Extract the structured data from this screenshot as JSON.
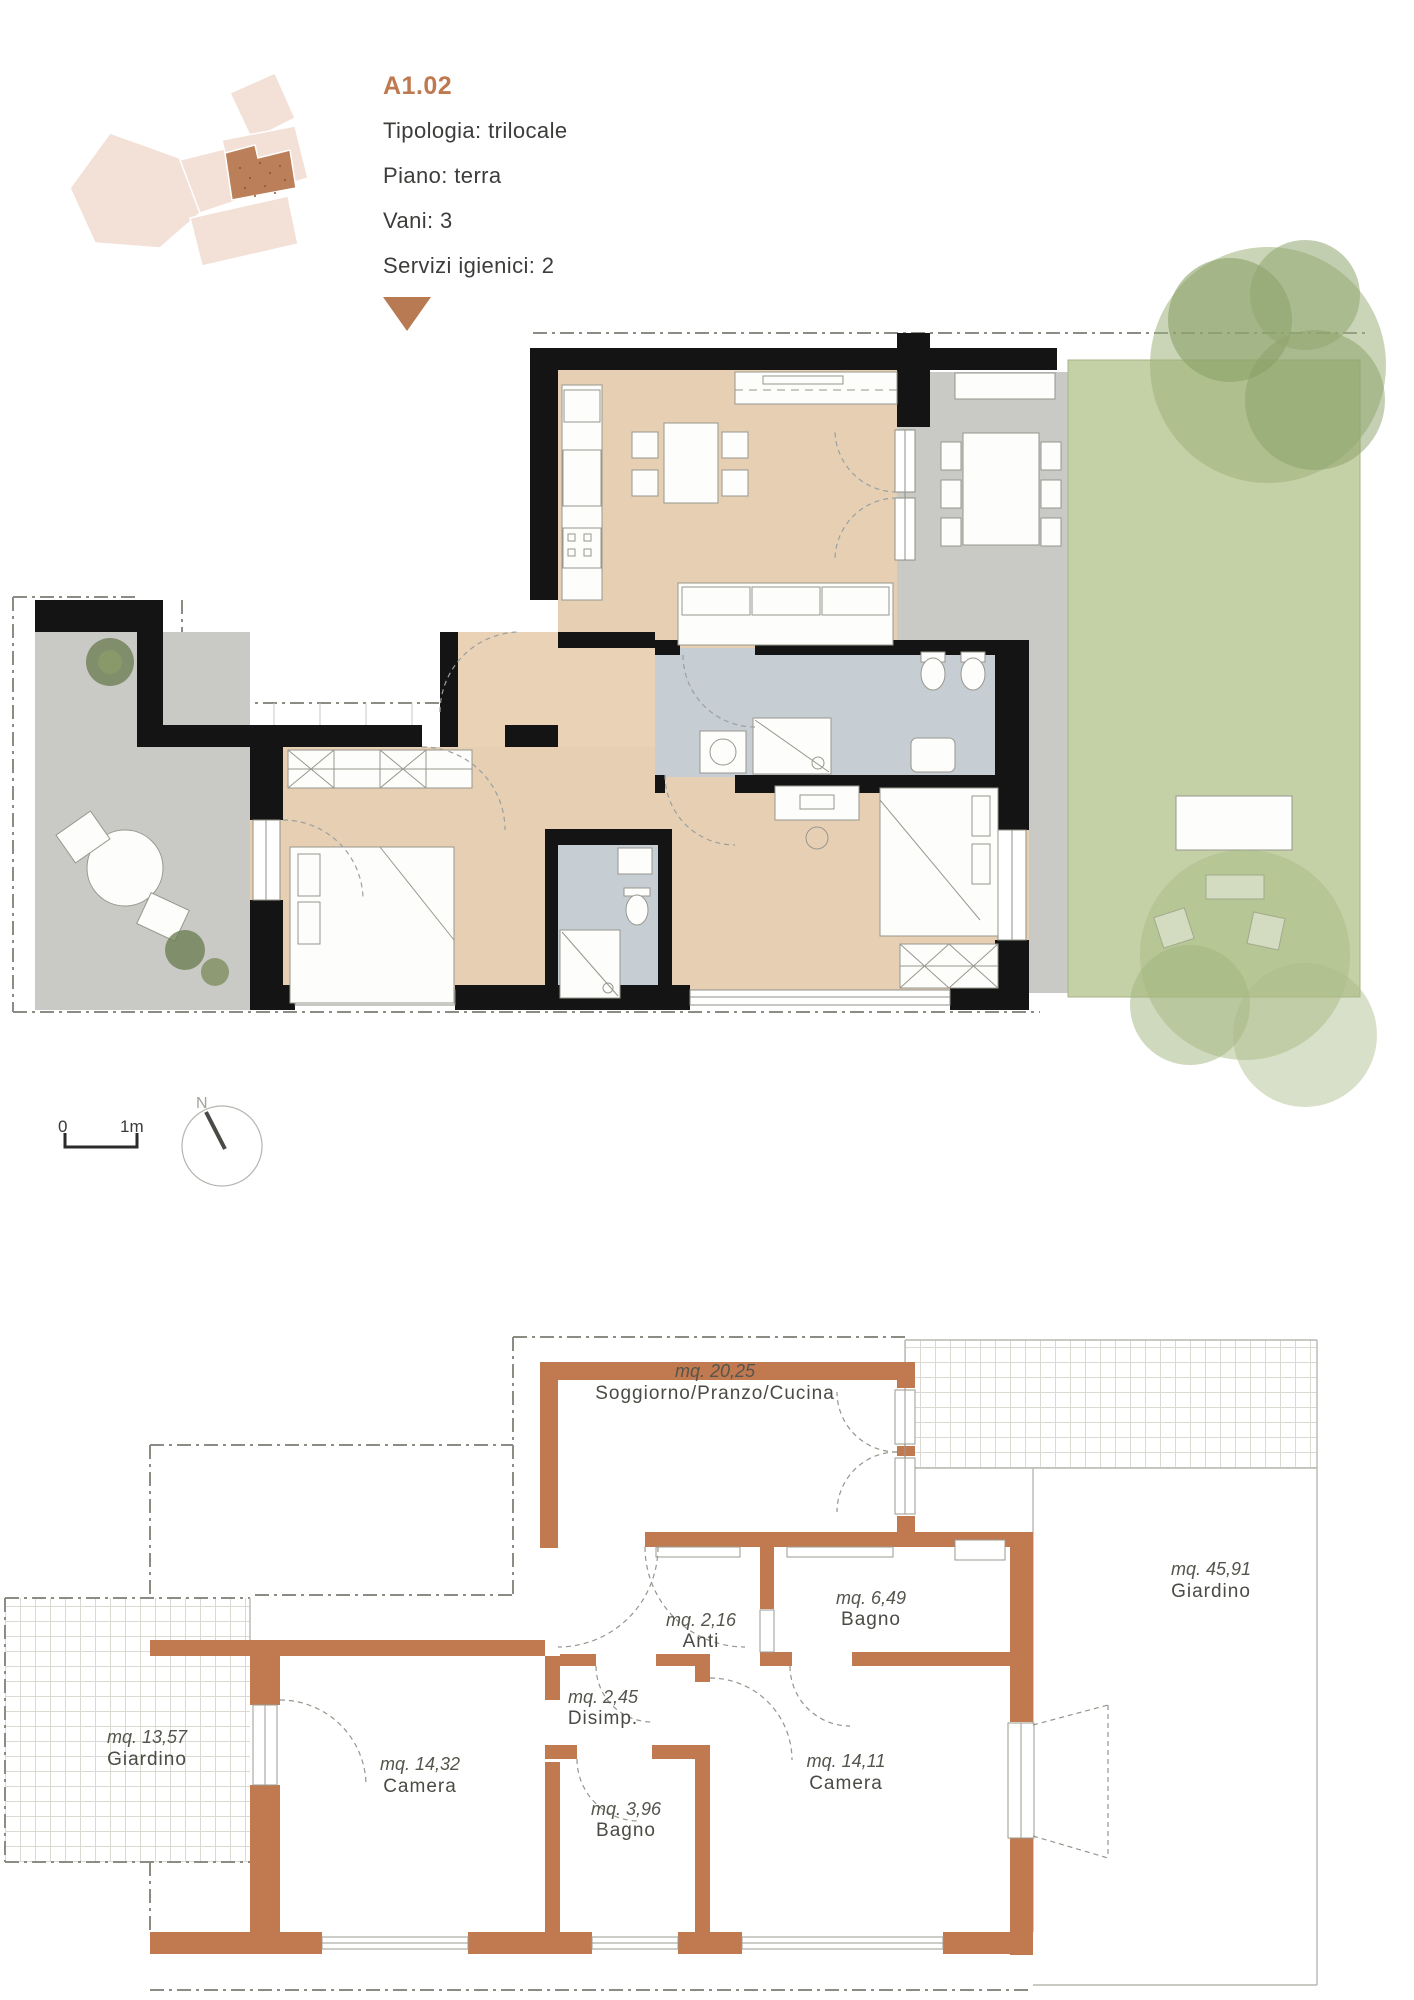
{
  "header": {
    "unit_code": "A1.02",
    "tipologia": "Tipologia: trilocale",
    "piano": "Piano: terra",
    "vani": "Vani: 3",
    "servizi": "Servizi igienici: 2"
  },
  "scale_bar": {
    "zero": "0",
    "one_meter": "1m"
  },
  "compass": {
    "north": "N"
  },
  "rooms": [
    {
      "area": "mq. 20,25",
      "name": "Soggiorno/Pranzo/Cucina"
    },
    {
      "area": "mq. 45,91",
      "name": "Giardino"
    },
    {
      "area": "mq. 6,49",
      "name": "Bagno"
    },
    {
      "area": "mq. 2,16",
      "name": "Anti"
    },
    {
      "area": "mq. 2,45",
      "name": "Disimp."
    },
    {
      "area": "mq. 13,57",
      "name": "Giardino"
    },
    {
      "area": "mq. 14,32",
      "name": "Camera"
    },
    {
      "area": "mq. 3,96",
      "name": "Bagno"
    },
    {
      "area": "mq. 14,11",
      "name": "Camera"
    }
  ],
  "colors": {
    "accent_orange": "#bf7950",
    "schematic_wall_orange": "#c1794f",
    "garden_green": "#c4d0a5",
    "terrace_gray": "#c9c9c5",
    "floor_beige": "#e7cfb3",
    "bath_tile_gray": "#c6cdd3",
    "wall_black": "#141414",
    "keyplan_pink": "#f3e0d6",
    "keyplan_highlight": "#bb7f5a"
  }
}
